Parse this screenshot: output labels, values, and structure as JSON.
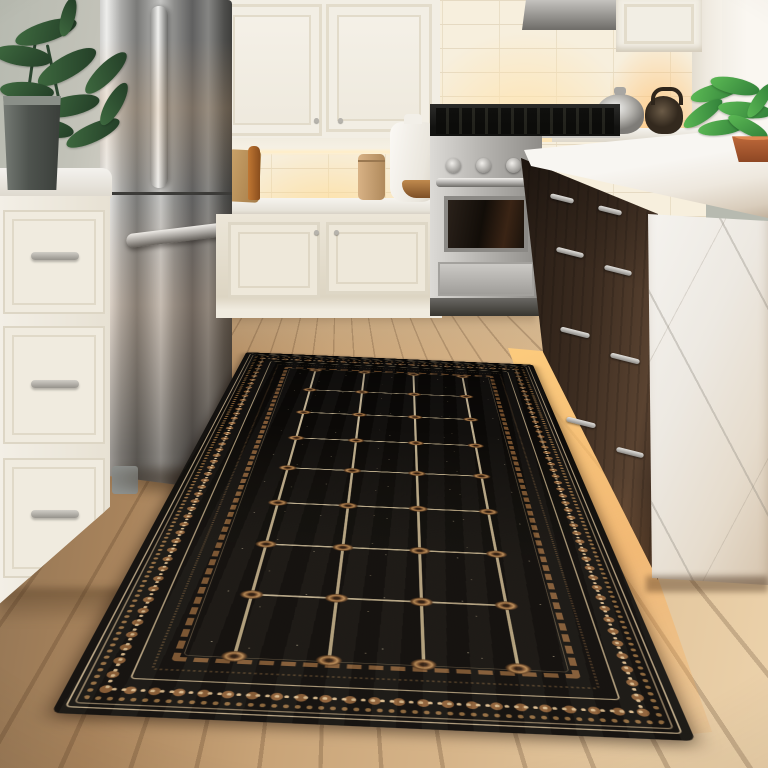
{
  "scene": {
    "title": "kitchen-with-black-runner-rug",
    "type": "photograph",
    "elements": [
      "sage wall",
      "potted plant on marble counter",
      "stainless french-door refrigerator",
      "white shaker cabinets",
      "subway tile backsplash with under-cabinet lighting",
      "stainless gas range",
      "kettles on back counter",
      "dark espresso kitchen island",
      "white marble waterfall countertop",
      "green plant in copper bowl",
      "light oak plank floor",
      "black runner rug with cream grid and brown rosettes and ornate borders",
      "toe-kick accent lighting"
    ]
  },
  "colors": {
    "wall_sage": "#b7bab0",
    "wall_bright": "#faf7f1",
    "pilaster": "#efeae0",
    "cab_white": "#f2eee4",
    "cab_frame": "#e3dccb",
    "knob": "#b6b3ac",
    "tile": "#f7efdd",
    "tile_grout": "#e6dac2",
    "glow": "#ffe3ae",
    "glow_strong": "#ffc77e",
    "floor_dark": "#8f7253",
    "floor_mid": "#c8a377",
    "floor_light": "#ecd2ab",
    "wood_dark": "#241a13",
    "wood_mid": "#3c2c20",
    "wood_hi": "#5a4331",
    "rug_black": "#0d0b09",
    "rug_field": "#0c0a08",
    "rug_cream": "#d9c8a4",
    "rug_brown": "#8a5c34",
    "rug_brown_hi": "#b98a54",
    "rug_brown_dk": "#5d3b1e",
    "rug_rope": "#7d5530",
    "rosette_core": "#2e1b0e",
    "pot_rim": "#8a8f88",
    "copper": "#c9713f",
    "copper_dk": "#8e4724"
  },
  "rug": {
    "rows": 8,
    "vertical_line_positions": [
      0.125,
      0.375,
      0.625,
      0.875
    ],
    "rosette_row_count": 9
  },
  "plants": {
    "left": {
      "color_light": "#3f6b40",
      "color_dark": "#223c26",
      "leaves": [
        {
          "x": 22,
          "y": 18,
          "w": 64,
          "h": 20,
          "r": -18
        },
        {
          "x": 2,
          "y": 42,
          "w": 58,
          "h": 20,
          "r": 8
        },
        {
          "x": 42,
          "y": 52,
          "w": 66,
          "h": 22,
          "r": -30
        },
        {
          "x": 8,
          "y": 78,
          "w": 54,
          "h": 18,
          "r": 4
        },
        {
          "x": 48,
          "y": 92,
          "w": 60,
          "h": 20,
          "r": -12
        },
        {
          "x": 86,
          "y": 60,
          "w": 56,
          "h": 18,
          "r": -45
        },
        {
          "x": 30,
          "y": 115,
          "w": 52,
          "h": 18,
          "r": 10
        },
        {
          "x": 72,
          "y": 120,
          "w": 58,
          "h": 18,
          "r": -25
        },
        {
          "x": 98,
          "y": 92,
          "w": 48,
          "h": 16,
          "r": -60
        },
        {
          "x": 56,
          "y": 6,
          "w": 40,
          "h": 14,
          "r": -75
        }
      ]
    },
    "right": {
      "color_light": "#5dbb55",
      "color_dark": "#2f7d38",
      "leaves": [
        {
          "x": 10,
          "y": 8,
          "w": 52,
          "h": 16,
          "r": -15
        },
        {
          "x": 30,
          "y": 2,
          "w": 50,
          "h": 16,
          "r": 12
        },
        {
          "x": 0,
          "y": 30,
          "w": 46,
          "h": 15,
          "r": -35
        },
        {
          "x": 38,
          "y": 26,
          "w": 54,
          "h": 16,
          "r": 6
        },
        {
          "x": 18,
          "y": 44,
          "w": 48,
          "h": 15,
          "r": -8
        },
        {
          "x": 46,
          "y": 44,
          "w": 44,
          "h": 14,
          "r": 28
        },
        {
          "x": 60,
          "y": 18,
          "w": 40,
          "h": 13,
          "r": -55
        }
      ]
    }
  },
  "island": {
    "handles": [
      {
        "x": 550,
        "y": 196,
        "w": 24
      },
      {
        "x": 598,
        "y": 208,
        "w": 24
      },
      {
        "x": 556,
        "y": 250,
        "w": 28
      },
      {
        "x": 604,
        "y": 268,
        "w": 28
      },
      {
        "x": 560,
        "y": 330,
        "w": 30
      },
      {
        "x": 610,
        "y": 356,
        "w": 30
      },
      {
        "x": 566,
        "y": 420,
        "w": 30
      },
      {
        "x": 616,
        "y": 450,
        "w": 28
      }
    ]
  },
  "range": {
    "knob_positions": [
      16,
      46,
      76
    ]
  },
  "left_cabinets": {
    "pull_offsets": [
      54,
      182,
      312
    ]
  }
}
